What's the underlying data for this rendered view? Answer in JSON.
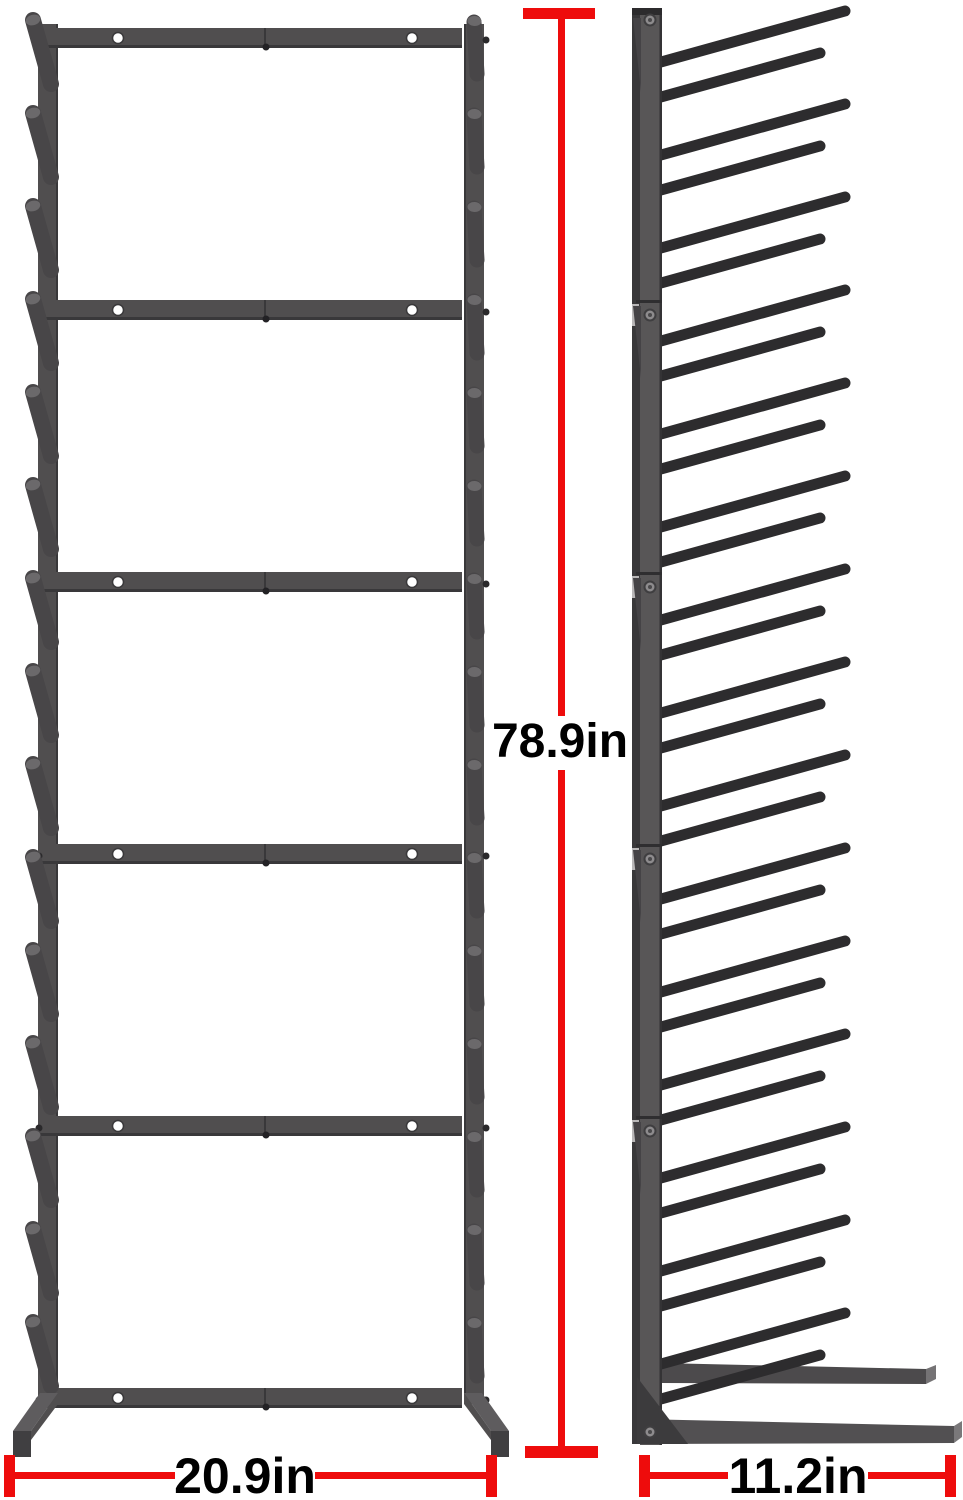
{
  "dimensions": {
    "height_label": "78.9in",
    "width_label": "20.9in",
    "depth_label": "11.2in"
  },
  "structure": {
    "sections": 5,
    "crossbars": 6,
    "pegs_per_side": 15,
    "side_rod_pairs": 15,
    "screw_holes_per_crossbar": 2
  },
  "colors": {
    "background": "#ffffff",
    "dimension_red": "#ee0c0c",
    "label_text": "#000000",
    "frame": "#504e4f",
    "frame_edge": "#39383a",
    "frame_light": "#8d8b8d",
    "joint_patch": "#b9b7b8",
    "peg": "#484648",
    "peg_cap": "#6b696b",
    "side_rod": "#2d2c2e",
    "foot_top": "#5e5c5e",
    "foot_front": "#403f41"
  }
}
